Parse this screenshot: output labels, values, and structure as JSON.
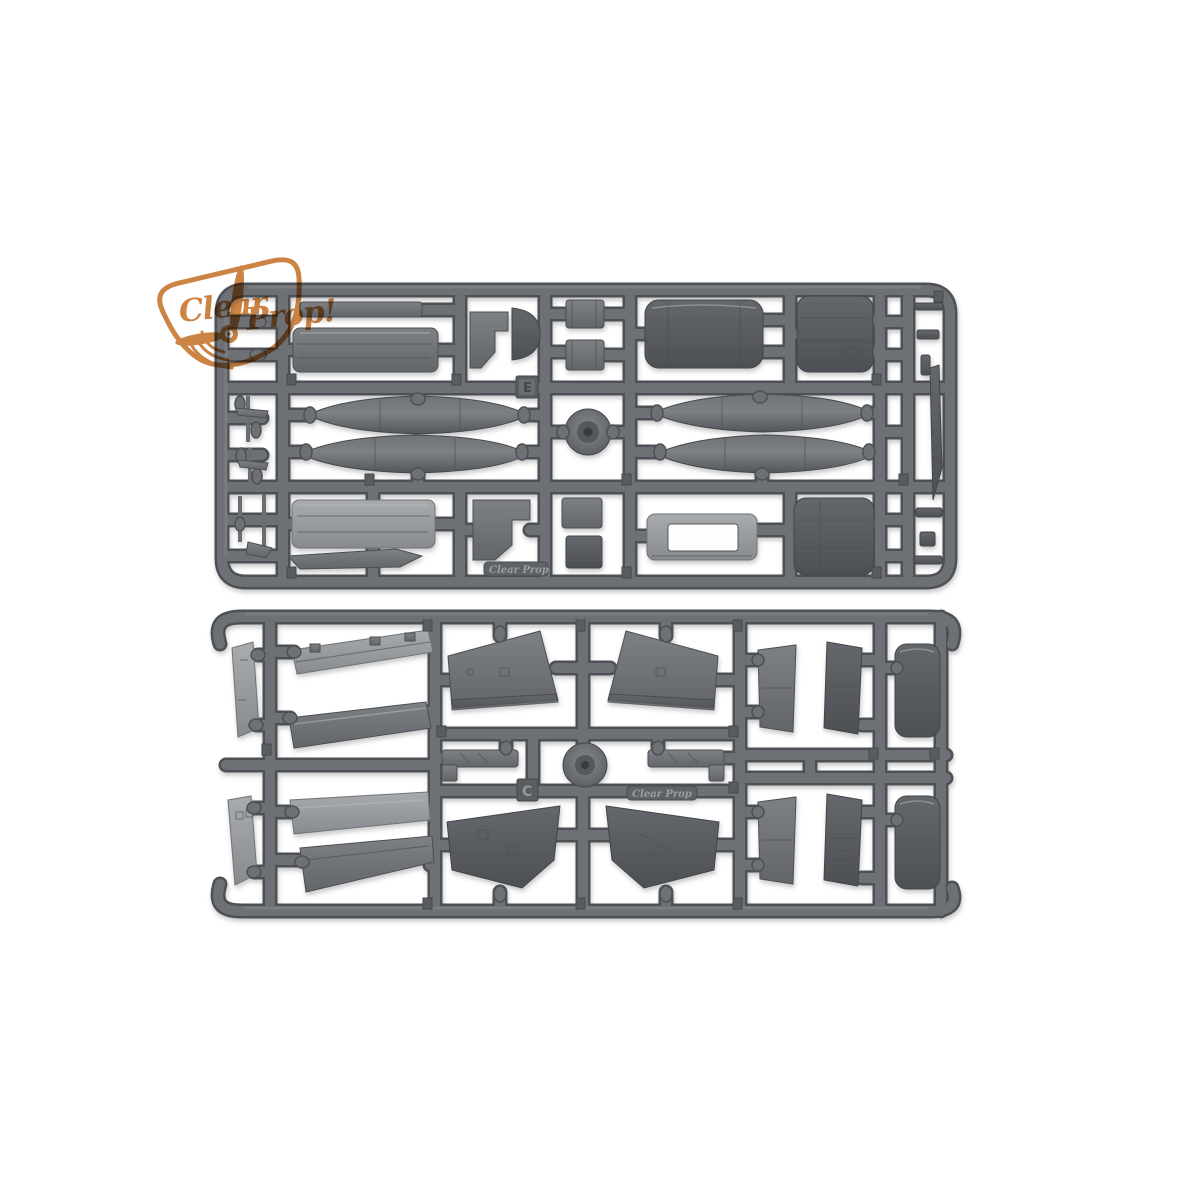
{
  "brand": {
    "word1": "Clear",
    "word2": "Prop!"
  },
  "sprues": {
    "top": {
      "letter": "E",
      "nameplate": "Clear Prop",
      "parts": [
        "cowling-panel",
        "engine-cowl",
        "stepped-bracket",
        "canopy",
        "small-blocks",
        "fuselage-half",
        "fuselage-half-2",
        "drop-tank",
        "drop-tank-2",
        "drop-tank-3",
        "drop-tank-4",
        "wheel-hub",
        "propeller-blade",
        "open-frame-insert",
        "fairing-strip",
        "gear-struts"
      ]
    },
    "bottom": {
      "letter": "C",
      "nameplate": "Clear Prop",
      "parts": [
        "rudder-half",
        "rudder-half-2",
        "flap",
        "flap-2",
        "flap-3",
        "flap-4",
        "wing-upper-left",
        "wing-upper-right",
        "wing-lower-left",
        "wing-lower-right",
        "landing-gear-left",
        "landing-gear-right",
        "spinner",
        "stabilizer-halves",
        "elevator-halves"
      ]
    }
  },
  "colors": {
    "background": "#ffffff",
    "logo_orange": "#c87a35",
    "rail_dark": "#4e5154",
    "rail_mid": "#6d7074",
    "plastic_dark_1": "#64676b",
    "plastic_dark_2": "#4d5054",
    "plastic_mid_1": "#7d8084",
    "plastic_mid_2": "#626569",
    "plastic_light_1": "#a9acaf",
    "plastic_light_2": "#878a8e",
    "tank_1": "#6f7276",
    "tank_2": "#53565a",
    "tag_fill": "#5a5d61",
    "emboss_text": "#94979b"
  }
}
